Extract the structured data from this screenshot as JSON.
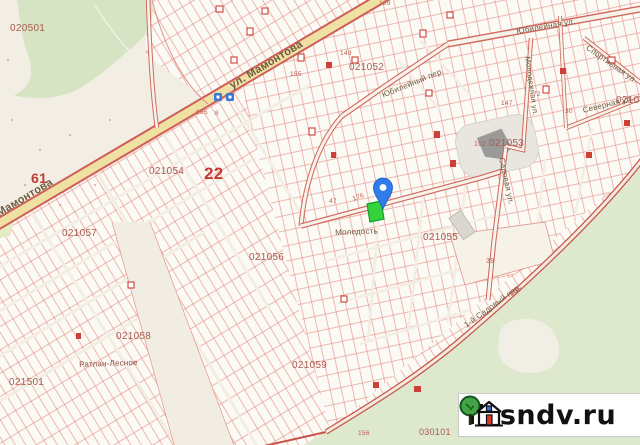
{
  "map": {
    "colors": {
      "background": "#f2eee4",
      "parcel_fill": "#fcfaf4",
      "parcel_line": "#e28d84",
      "road_border": "#cf5f56",
      "main_road_fill": "#efe0a3",
      "minor_road_fill": "#f6f3ea",
      "forest_green": "#d7e4c4",
      "meadow_green": "#dde8cd",
      "quarter_label": "#a85a50",
      "block_number": "#c23b33",
      "street_label": "#6e5b40",
      "pin_blue": "#2e7bea",
      "selected_parcel_green": "#35d23c",
      "bus_stop_blue": "#3b77d6"
    },
    "quarter_labels": [
      {
        "text": "020501",
        "x": 10,
        "y": 24,
        "fs": 10
      },
      {
        "text": "021052",
        "x": 349,
        "y": 63,
        "fs": 10
      },
      {
        "text": "021053",
        "x": 489,
        "y": 139,
        "fs": 10
      },
      {
        "text": "021054",
        "x": 149,
        "y": 167,
        "fs": 10
      },
      {
        "text": "021055",
        "x": 423,
        "y": 233,
        "fs": 10
      },
      {
        "text": "021056",
        "x": 249,
        "y": 253,
        "fs": 10
      },
      {
        "text": "021057",
        "x": 62,
        "y": 229,
        "fs": 10
      },
      {
        "text": "021058",
        "x": 116,
        "y": 332,
        "fs": 10
      },
      {
        "text": "021059",
        "x": 292,
        "y": 361,
        "fs": 10
      },
      {
        "text": "021501",
        "x": 9,
        "y": 378,
        "fs": 10
      },
      {
        "text": "030101",
        "x": 419,
        "y": 428,
        "fs": 9
      },
      {
        "text": "02105",
        "x": 616,
        "y": 96,
        "fs": 10
      },
      {
        "text": "22",
        "x": 204,
        "y": 165,
        "fs": 17,
        "bold": true,
        "color": "#c23b33"
      },
      {
        "text": "61",
        "x": 31,
        "y": 171,
        "fs": 14,
        "bold": true,
        "color": "#c23b33"
      }
    ],
    "street_labels": [
      {
        "text": "ул. Мамонтова",
        "x": 228,
        "y": 82,
        "rot": -31,
        "fs": 11,
        "bold": true
      },
      {
        "text": "ул. Мамонтова",
        "x": -22,
        "y": 220,
        "rot": -31,
        "fs": 11,
        "bold": true
      },
      {
        "text": "Юбилейная ул.",
        "x": 516,
        "y": 28,
        "rot": -10,
        "fs": 8
      },
      {
        "text": "Юбилейный пер.",
        "x": 381,
        "y": 92,
        "rot": -22,
        "fs": 8
      },
      {
        "text": "Спортивная ул.",
        "x": 589,
        "y": 44,
        "rot": 35,
        "fs": 8
      },
      {
        "text": "Северная ул.",
        "x": 582,
        "y": 107,
        "rot": -14,
        "fs": 8
      },
      {
        "text": "Садовая ул.",
        "x": 505,
        "y": 157,
        "rot": 78,
        "fs": 8
      },
      {
        "text": "Молодежная ул.",
        "x": 531,
        "y": 56,
        "rot": 82,
        "fs": 7.5
      },
      {
        "text": "1-й Садовый пер.",
        "x": 463,
        "y": 323,
        "rot": -36,
        "fs": 8
      },
      {
        "text": "Молодость",
        "x": 335,
        "y": 229,
        "rot": -2,
        "fs": 8
      },
      {
        "text": "Ратлан-Лесное",
        "x": 79,
        "y": 361,
        "rot": -2,
        "fs": 8,
        "color": "#8a4a40"
      }
    ],
    "parcel_numbers": [
      {
        "text": "169",
        "x": 379,
        "y": 1,
        "fs": 6.5
      },
      {
        "text": "149",
        "x": 340,
        "y": 51,
        "fs": 6.5
      },
      {
        "text": "155",
        "x": 290,
        "y": 72,
        "fs": 6.5
      },
      {
        "text": "147",
        "x": 501,
        "y": 101,
        "fs": 6.5
      },
      {
        "text": "176",
        "x": 352,
        "y": 197,
        "fs": 6.5,
        "rot": -20
      },
      {
        "text": "47",
        "x": 329,
        "y": 199,
        "fs": 6.5
      },
      {
        "text": "39",
        "x": 486,
        "y": 258,
        "fs": 7
      },
      {
        "text": "30",
        "x": 565,
        "y": 109,
        "fs": 6.5
      },
      {
        "text": "168",
        "x": 509,
        "y": 293,
        "fs": 6.5,
        "rot": -38
      },
      {
        "text": "156",
        "x": 358,
        "y": 431,
        "fs": 6.5
      },
      {
        "text": "102",
        "x": 474,
        "y": 141,
        "fs": 7
      },
      {
        "text": "665",
        "x": 196,
        "y": 110,
        "fs": 6.5
      },
      {
        "text": "8",
        "x": 215,
        "y": 111,
        "fs": 6.5
      },
      {
        "text": "72",
        "x": 533,
        "y": 92,
        "fs": 6.5
      }
    ]
  },
  "marker": {
    "type": "location-pin",
    "pin_color": "#2e7bea",
    "selected_parcel_color": "#35d23c"
  },
  "watermark": {
    "site": "rosndv.ru",
    "icons": [
      "tree-icon",
      "house-icon"
    ]
  }
}
